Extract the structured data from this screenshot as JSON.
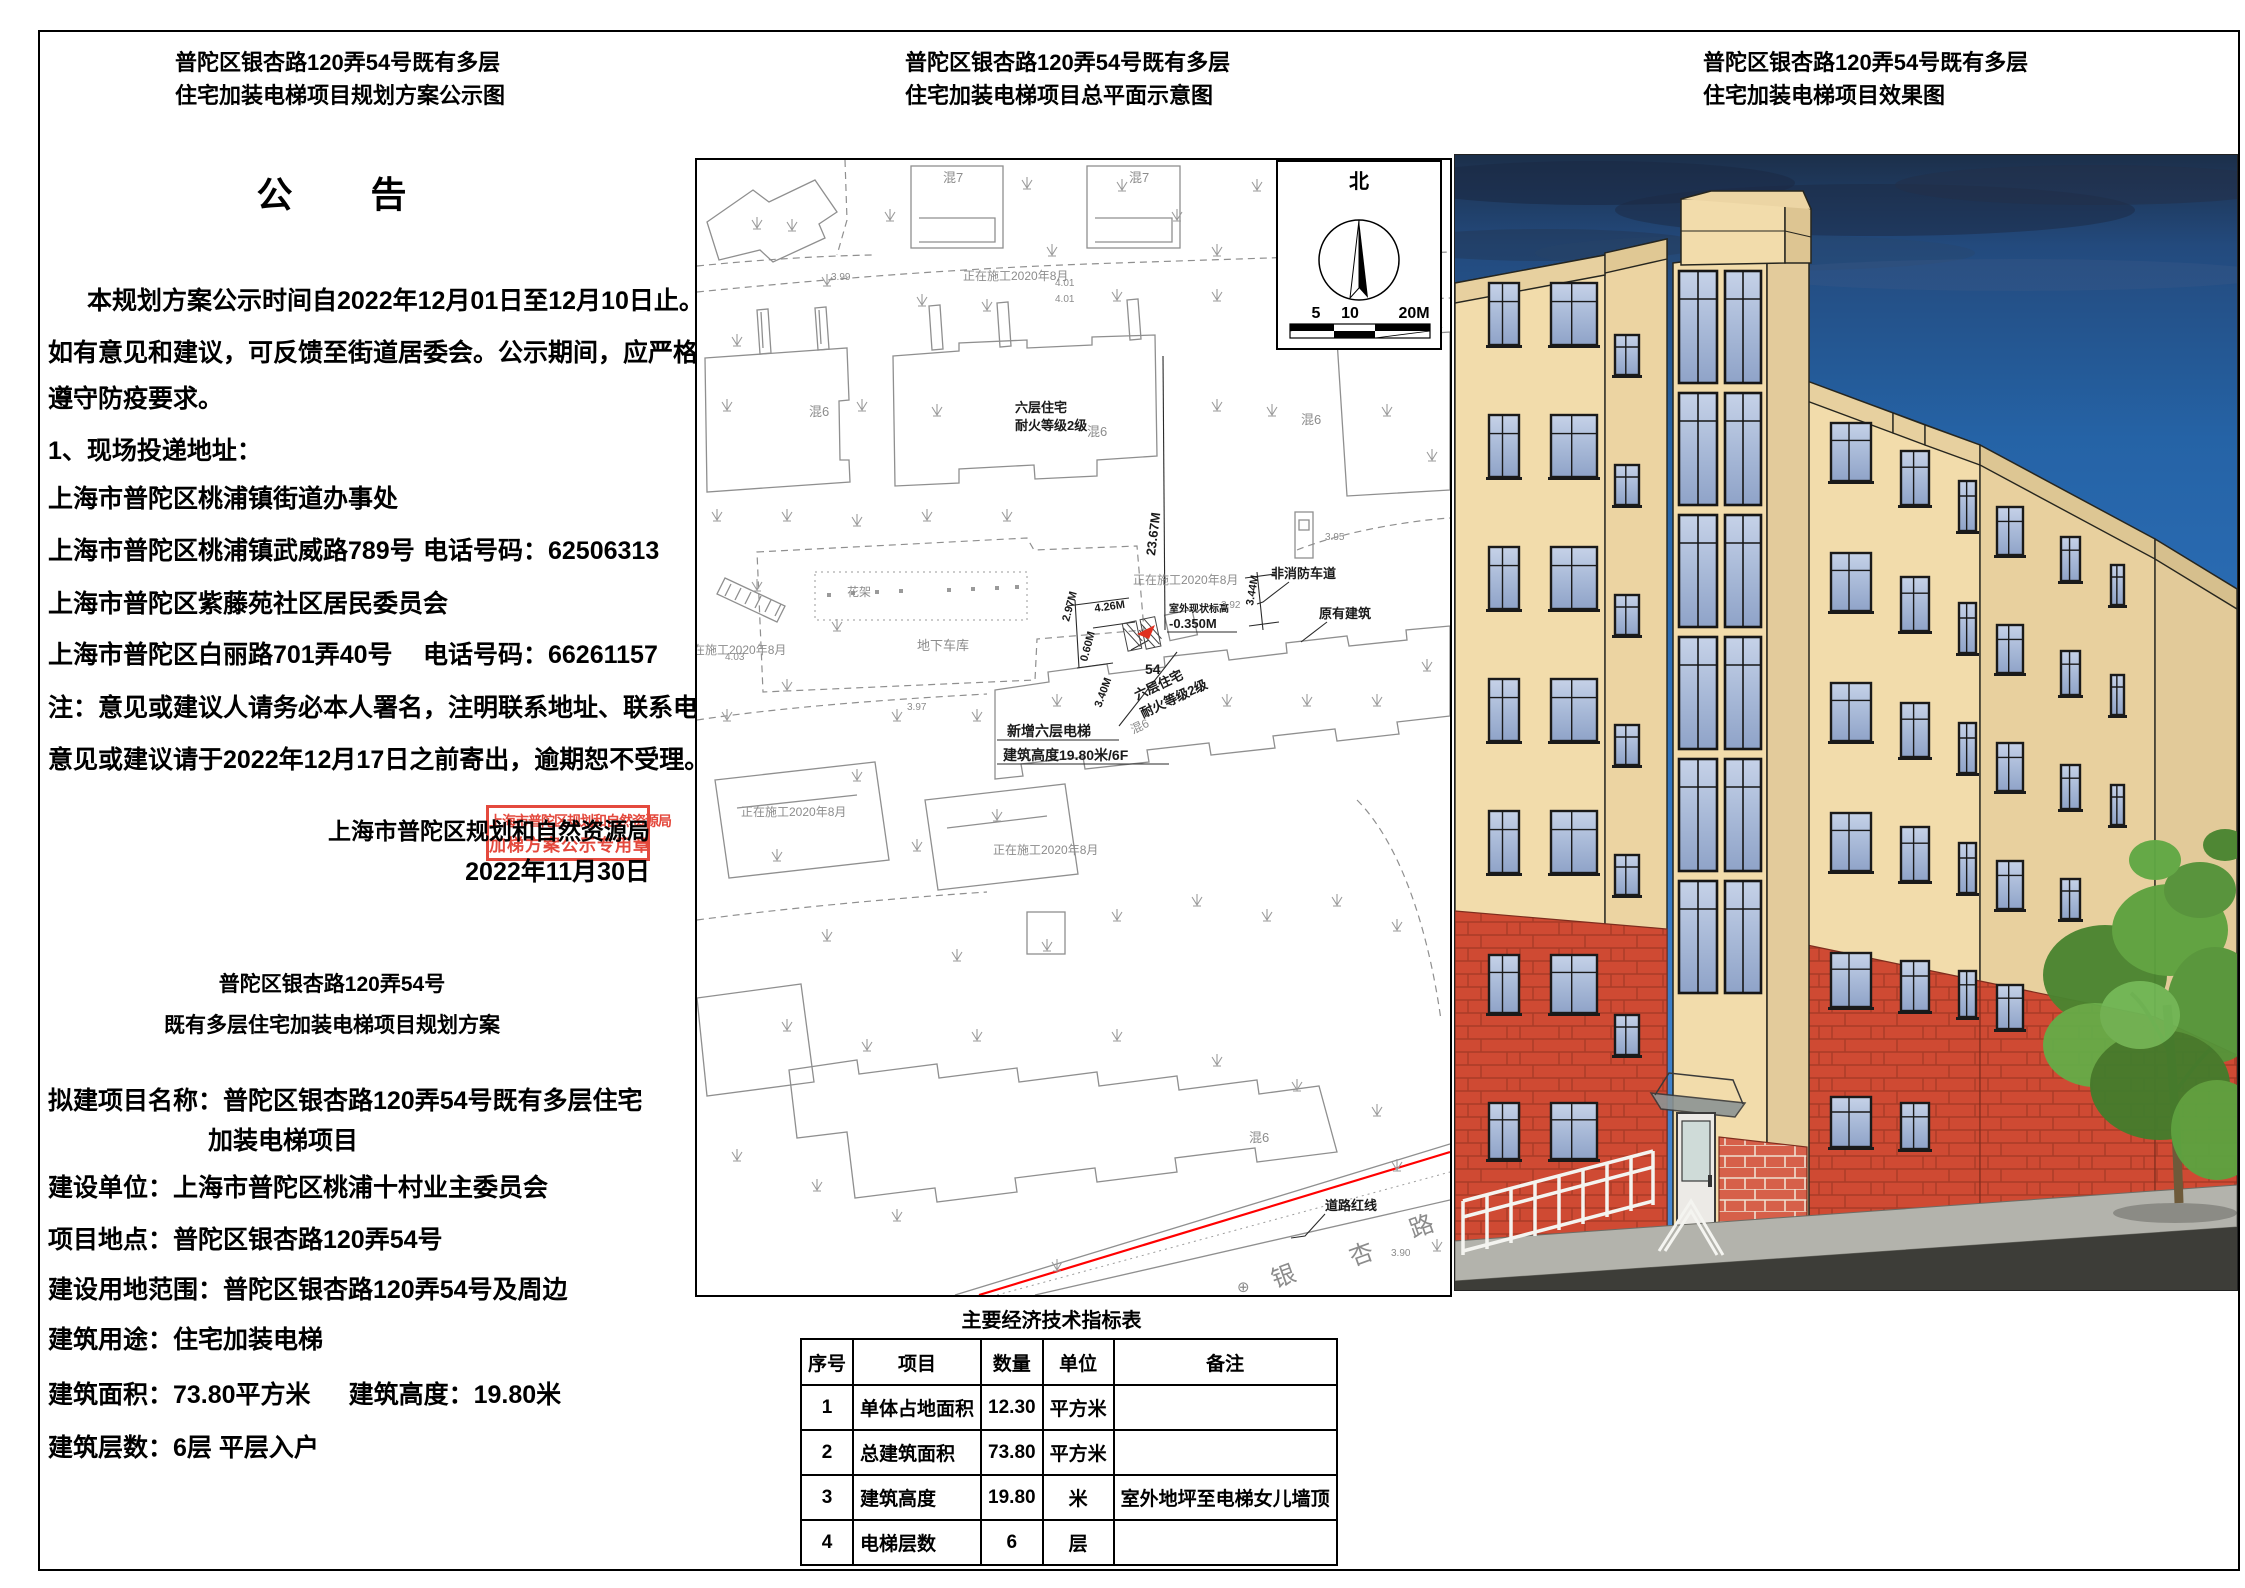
{
  "left": {
    "title_lines": [
      "普陀区银杏路120弄54号既有多层",
      "住宅加装电梯项目规划方案公示图"
    ],
    "notice_heading": "公　　告",
    "intro_lines": [
      {
        "text": "本规划方案公示时间自2022年12月01日至12月10日止。"
      },
      {
        "text": "如有意见和建议，可反馈至街道居委会。公示期间，应严格"
      },
      {
        "text": "遵守防疫要求。"
      }
    ],
    "list_heading": "1、现场投递地址：",
    "address_lines": [
      {
        "text": "上海市普陀区桃浦镇街道办事处",
        "phone": ""
      },
      {
        "text": "上海市普陀区桃浦镇武威路789号",
        "phone": "电话号码：62506313"
      },
      {
        "text": "上海市普陀区紫藤苑社区居民委员会",
        "phone": ""
      },
      {
        "text": "上海市普陀区白丽路701弄40号",
        "phone": "电话号码：66261157"
      }
    ],
    "note_lines": [
      "注：意见或建议人请务必本人署名，注明联系地址、联系电话。",
      "意见或建议请于2022年12月17日之前寄出，逾期恕不受理。"
    ],
    "signature": "上海市普陀区规划和自然资源局",
    "date": "2022年11月30日",
    "stamp": {
      "line1": "上海市普陀区规划和自然资源局",
      "line2": "加梯方案公示专用章",
      "color": "#e2392c"
    },
    "scheme_title_lines": [
      "普陀区银杏路120弄54号",
      "既有多层住宅加装电梯项目规划方案"
    ],
    "details": [
      {
        "text": "拟建项目名称：普陀区银杏路120弄54号既有多层住宅"
      },
      {
        "text": "加装电梯项目"
      },
      {
        "text": "建设单位：上海市普陀区桃浦十村业主委员会"
      },
      {
        "text": "项目地点：普陀区银杏路120弄54号"
      },
      {
        "text": "建设用地范围：普陀区银杏路120弄54号及周边"
      },
      {
        "text": "建筑用途：住宅加装电梯"
      },
      {
        "text": "建筑面积：73.80平方米",
        "text2": "建筑高度：19.80米"
      },
      {
        "text": "建筑层数：6层 平层入户"
      }
    ]
  },
  "middle": {
    "title_lines": [
      "普陀区银杏路120弄54号既有多层",
      "住宅加装电梯项目总平面示意图"
    ],
    "compass": {
      "north": "北",
      "scale_labels": [
        "5",
        "10",
        "20M"
      ]
    },
    "map": {
      "red_line_color": "#ff0000",
      "labels": [
        {
          "t": "混7",
          "x": 246,
          "y": 22,
          "f": 13,
          "c": "g"
        },
        {
          "t": "混7",
          "x": 432,
          "y": 22,
          "f": 13,
          "c": "g"
        },
        {
          "t": "正在施工2020年8月",
          "x": 266,
          "y": 120,
          "f": 12,
          "c": "g"
        },
        {
          "t": "3.99",
          "x": 134,
          "y": 120,
          "f": 10,
          "c": "g"
        },
        {
          "t": "4.01",
          "x": 358,
          "y": 126,
          "f": 10,
          "c": "g"
        },
        {
          "t": "4.01",
          "x": 358,
          "y": 142,
          "f": 10,
          "c": "g"
        },
        {
          "t": "混6",
          "x": 112,
          "y": 256,
          "f": 13,
          "c": "g"
        },
        {
          "t": "六层住宅",
          "x": 318,
          "y": 252,
          "f": 13,
          "c": "k",
          "w": 1
        },
        {
          "t": "耐火等级2级",
          "x": 318,
          "y": 270,
          "f": 13,
          "c": "k",
          "w": 1
        },
        {
          "t": "混6",
          "x": 390,
          "y": 276,
          "f": 13,
          "c": "g"
        },
        {
          "t": "混6",
          "x": 604,
          "y": 264,
          "f": 13,
          "c": "g"
        },
        {
          "t": "正在施工2020年8月",
          "x": 436,
          "y": 424,
          "f": 12,
          "c": "g"
        },
        {
          "t": "非消防车道",
          "x": 574,
          "y": 418,
          "f": 13,
          "c": "k",
          "w": 1
        },
        {
          "t": "原有建筑",
          "x": 622,
          "y": 458,
          "f": 13,
          "c": "k",
          "w": 1
        },
        {
          "t": "室外现状标高",
          "x": 472,
          "y": 452,
          "f": 10,
          "c": "k",
          "w": 1
        },
        {
          "t": "-0.350M",
          "x": 472,
          "y": 468,
          "f": 13,
          "c": "k",
          "w": 1
        },
        {
          "t": "23.67M",
          "x": 458,
          "y": 396,
          "f": 13,
          "c": "k",
          "w": 1,
          "r": -83
        },
        {
          "t": "2.97M",
          "x": 372,
          "y": 462,
          "f": 11,
          "c": "k",
          "w": 1,
          "r": -75
        },
        {
          "t": "4.26M",
          "x": 398,
          "y": 452,
          "f": 11,
          "c": "k",
          "w": 1,
          "r": -8
        },
        {
          "t": "0.60M",
          "x": 390,
          "y": 502,
          "f": 11,
          "c": "k",
          "w": 1,
          "r": -75
        },
        {
          "t": "3.40M",
          "x": 404,
          "y": 548,
          "f": 11,
          "c": "k",
          "w": 1,
          "r": -70
        },
        {
          "t": "3.44M",
          "x": 556,
          "y": 446,
          "f": 11,
          "c": "k",
          "w": 1,
          "r": -80
        },
        {
          "t": "3.92",
          "x": 524,
          "y": 448,
          "f": 10,
          "c": "g"
        },
        {
          "t": "3.95",
          "x": 628,
          "y": 380,
          "f": 10,
          "c": "g"
        },
        {
          "t": "54",
          "x": 448,
          "y": 514,
          "f": 14,
          "c": "k",
          "w": 1
        },
        {
          "t": "六层住宅",
          "x": 440,
          "y": 540,
          "f": 13,
          "c": "k",
          "w": 1,
          "r": -25
        },
        {
          "t": "耐火等级2级",
          "x": 446,
          "y": 558,
          "f": 13,
          "c": "k",
          "w": 1,
          "r": -25
        },
        {
          "t": "混6",
          "x": 436,
          "y": 574,
          "f": 12,
          "c": "g",
          "r": -25
        },
        {
          "t": "新增六层电梯",
          "x": 310,
          "y": 576,
          "f": 14,
          "c": "k",
          "w": 1
        },
        {
          "t": "建筑高度19.80米/6F",
          "x": 306,
          "y": 600,
          "f": 14,
          "c": "k",
          "w": 1
        },
        {
          "t": "花架",
          "x": 150,
          "y": 436,
          "f": 12,
          "c": "g"
        },
        {
          "t": "地下车库",
          "x": 220,
          "y": 490,
          "f": 13,
          "c": "g"
        },
        {
          "t": "4.03",
          "x": 28,
          "y": 500,
          "f": 10,
          "c": "g"
        },
        {
          "t": "3.97",
          "x": 210,
          "y": 550,
          "f": 10,
          "c": "g"
        },
        {
          "t": "正在施工2020年8月",
          "x": 296,
          "y": 694,
          "f": 12,
          "c": "g"
        },
        {
          "t": "正在施工2020年8月",
          "x": 44,
          "y": 656,
          "f": 12,
          "c": "g"
        },
        {
          "t": "正在施工2020年8月",
          "x": -16,
          "y": 494,
          "f": 12,
          "c": "g"
        },
        {
          "t": "混6",
          "x": 552,
          "y": 982,
          "f": 13,
          "c": "g"
        },
        {
          "t": "道路红线",
          "x": 628,
          "y": 1050,
          "f": 13,
          "c": "k",
          "w": 1
        },
        {
          "t": "银",
          "x": 578,
          "y": 1128,
          "f": 24,
          "c": "g",
          "r": -20
        },
        {
          "t": "杏",
          "x": 656,
          "y": 1106,
          "f": 24,
          "c": "g",
          "r": -20
        },
        {
          "t": "路",
          "x": 716,
          "y": 1078,
          "f": 24,
          "c": "g",
          "r": -20
        },
        {
          "t": "3.90",
          "x": 694,
          "y": 1096,
          "f": 10,
          "c": "g"
        },
        {
          "t": "⊕",
          "x": 540,
          "y": 1132,
          "f": 15,
          "c": "g"
        }
      ]
    },
    "table": {
      "title": "主要经济技术指标表",
      "headers": [
        "序号",
        "项目",
        "数量",
        "单位",
        "备注"
      ],
      "rows": [
        [
          "1",
          "单体占地面积",
          "12.30",
          "平方米",
          ""
        ],
        [
          "2",
          "总建筑面积",
          "73.80",
          "平方米",
          ""
        ],
        [
          "3",
          "建筑高度",
          "19.80",
          "米",
          "室外地坪至电梯女儿墙顶"
        ],
        [
          "4",
          "电梯层数",
          "6",
          "层",
          ""
        ]
      ]
    }
  },
  "right": {
    "title_lines": [
      "普陀区银杏路120弄54号既有多层",
      "住宅加装电梯项目效果图"
    ],
    "render_colors": {
      "sky": "#2c6ab4",
      "facade": "#f2dcab",
      "facade_shade": "#e2ca99",
      "brick": "#cf4a33",
      "glass": "#a9bad8",
      "tree": "#57973c"
    }
  }
}
